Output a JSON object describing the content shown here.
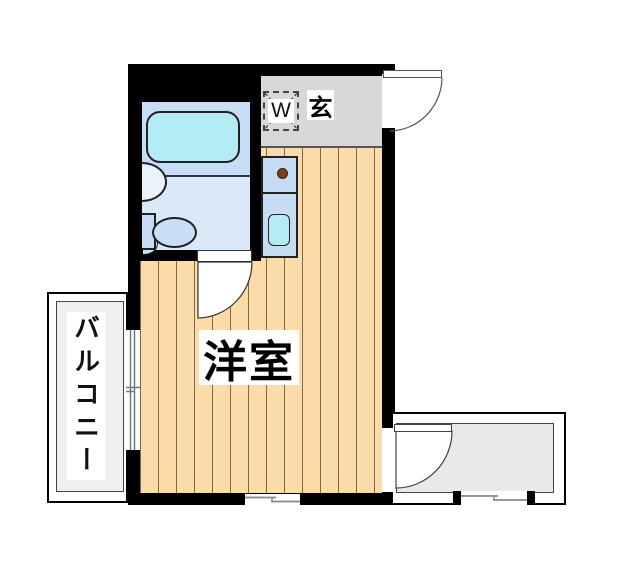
{
  "labels": {
    "entrance": "玄",
    "washer": "W",
    "main_room": "洋室",
    "balcony": "バルコニー"
  },
  "colors": {
    "wall": "#000000",
    "flooring": "#FBDBA7",
    "plank": "#7C6A4D",
    "bathroom_upper": "#C6DDF5",
    "bathroom_floor": "#DAE9F8",
    "fixture": "#C5DCF4",
    "water": "#B3ECF4",
    "entrance": "#D8D8D8",
    "balcony": "#F0F0F0",
    "exterior": "#E9E9E9",
    "burner": "#7B3F12",
    "outline": "#222222"
  }
}
